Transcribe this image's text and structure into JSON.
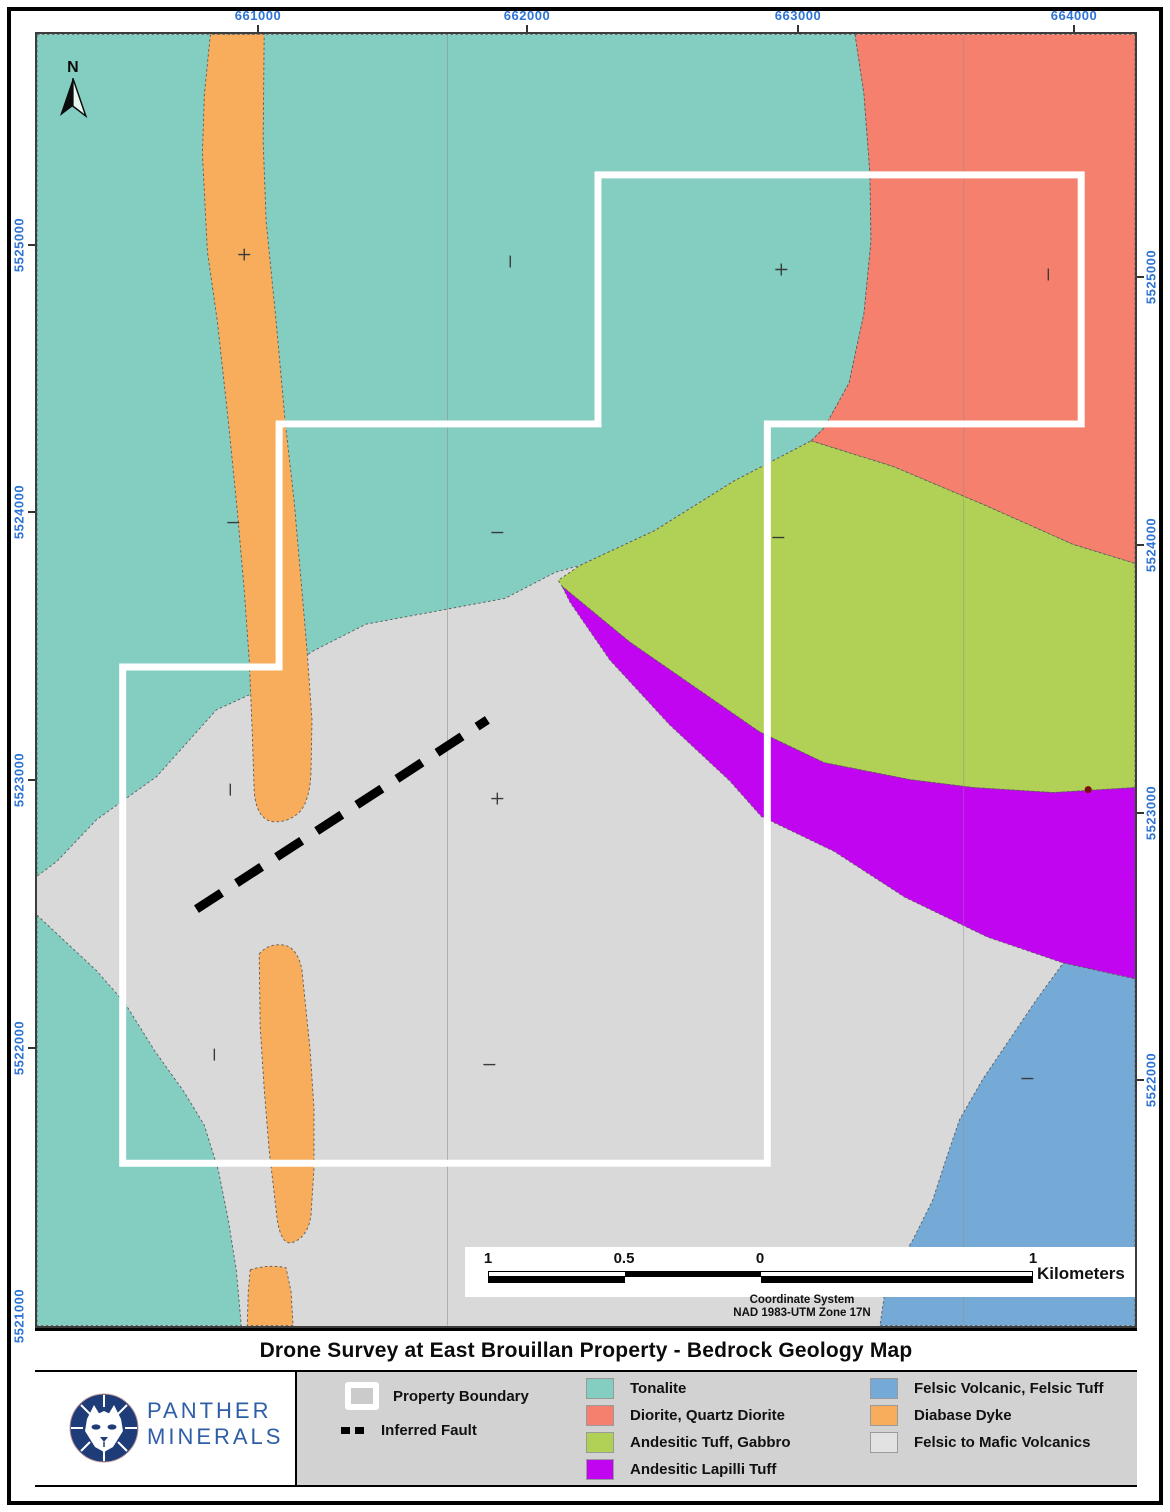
{
  "title": "Drone Survey at East Brouillan Property - Bedrock Geology Map",
  "compass": {
    "label": "N"
  },
  "axes": {
    "top": [
      "661000",
      "662000",
      "663000",
      "664000"
    ],
    "left": [
      "5525000",
      "5524000",
      "5523000",
      "5522000",
      "5521000"
    ],
    "right": [
      "5525000",
      "5524000",
      "5523000",
      "5522000"
    ]
  },
  "scalebar": {
    "ticks": [
      "1",
      "0.5",
      "0",
      "1"
    ],
    "unit": "Kilometers"
  },
  "coordinate_system": {
    "line1": "Coordinate System",
    "line2": "NAD 1983-UTM Zone 17N"
  },
  "legend": {
    "property_boundary_label": "Property Boundary",
    "inferred_fault_label": "Inferred Fault",
    "units": [
      {
        "label": "Tonalite",
        "color": "#84CEC1"
      },
      {
        "label": "Diorite, Quartz Diorite",
        "color": "#F5806E"
      },
      {
        "label": "Andesitic Tuff, Gabbro",
        "color": "#B0D155"
      },
      {
        "label": "Andesitic Lapilli Tuff",
        "color": "#C205F0"
      },
      {
        "label": "Felsic Volcanic, Felsic Tuff",
        "color": "#76AAD6"
      },
      {
        "label": "Diabase Dyke",
        "color": "#F7AD5C"
      },
      {
        "label": "Felsic to Mafic Volcanics",
        "color": "#E2E2E2"
      }
    ]
  },
  "logo": {
    "line1": "PANTHER",
    "line2": "MINERALS"
  },
  "colors": {
    "tonalite": "#84CEC1",
    "diorite": "#F5806E",
    "andesitic_tuff_gabbro": "#B0D155",
    "andesitic_lapilli_tuff": "#C205F0",
    "felsic_volcanic": "#76AAD6",
    "diabase_dyke": "#F7AD5C",
    "felsic_to_mafic": "#D9D9D9",
    "property_boundary": "#FFFFFF",
    "fault": "#000000",
    "axis_label": "#2E74D4"
  }
}
